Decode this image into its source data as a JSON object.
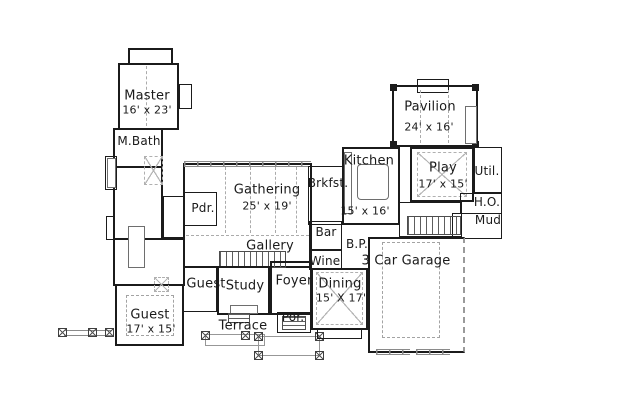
{
  "plan": {
    "title": "house-floor-plan",
    "rooms": {
      "master": {
        "label": "Master",
        "dims": "16' x 23'"
      },
      "mbath": {
        "label": "M.Bath"
      },
      "pdr": {
        "label": "Pdr."
      },
      "gathering": {
        "label": "Gathering",
        "dims": "25' x 19'"
      },
      "gallery": {
        "label": "Gallery"
      },
      "brkfst": {
        "label": "Brkfst."
      },
      "kitchen": {
        "label": "Kitchen",
        "dims": "15' x 16'"
      },
      "pavilion": {
        "label": "Pavilion",
        "dims": "24' x 16'"
      },
      "play": {
        "label": "Play",
        "dims": "17' x 15'"
      },
      "util": {
        "label": "Util."
      },
      "ho": {
        "label": "H.O."
      },
      "mud": {
        "label": "Mud"
      },
      "bar": {
        "label": "Bar"
      },
      "bp": {
        "label": "B.P."
      },
      "wine": {
        "label": "Wine"
      },
      "garage": {
        "label": "3 Car Garage"
      },
      "guest_hall": {
        "label": "Guest"
      },
      "study": {
        "label": "Study"
      },
      "foyer": {
        "label": "Foyer"
      },
      "dining": {
        "label": "Dining",
        "dims": "15' X 17'"
      },
      "guest_bedroom": {
        "label": "Guest",
        "dims": "17' x 15'"
      },
      "terrace": {
        "label": "Terrace"
      },
      "porch": {
        "label": "Por."
      }
    },
    "colors": {
      "wall": "#1b1b1b",
      "light_line": "#8a8a8a",
      "text": "#1a1a1a",
      "background": "#ffffff"
    }
  }
}
